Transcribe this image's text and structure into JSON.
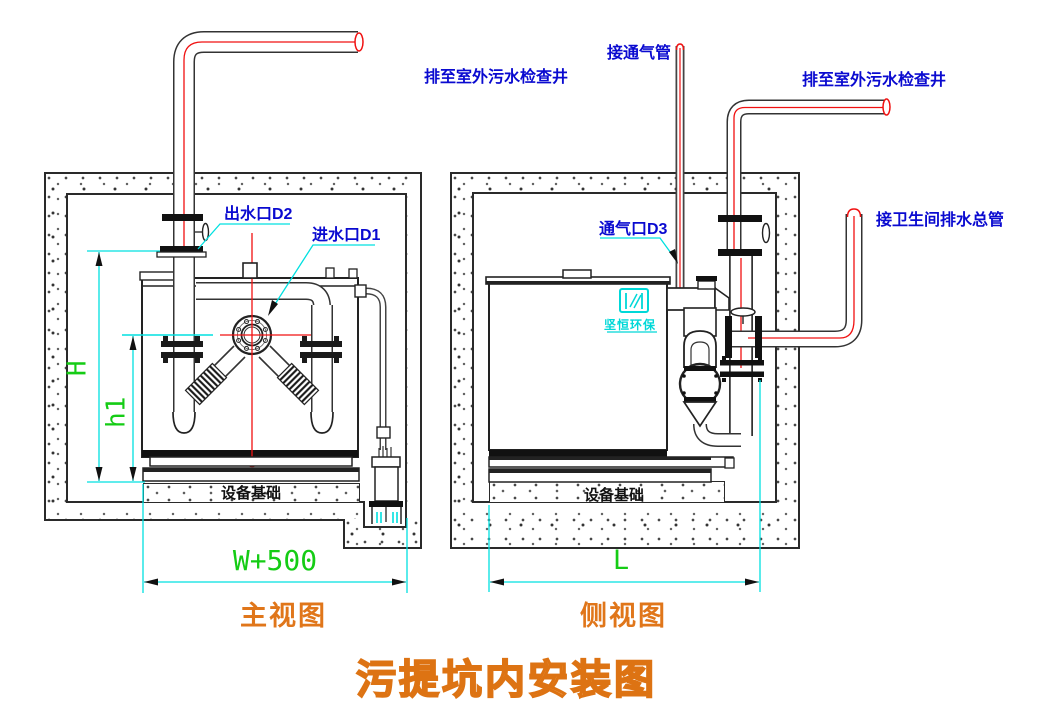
{
  "drawing_title": "污提坑内安装图",
  "front_view": {
    "caption": "主视图",
    "annotations": {
      "outfall": "排至室外污水检查井",
      "outlet": "出水口D2",
      "inlet": "进水口D1",
      "foundation": "设备基础"
    },
    "dimensions": {
      "pit_height": "H",
      "inlet_height": "h1",
      "pit_width": "W+500"
    }
  },
  "side_view": {
    "caption": "侧视图",
    "annotations": {
      "vent_connect": "接通气管",
      "outfall": "排至室外污水检查井",
      "vent_port": "通气口D3",
      "toilet_main": "接卫生间排水总管",
      "foundation": "设备基础"
    },
    "dimensions": {
      "pit_length": "L"
    }
  },
  "logo": {
    "brand": "坚恒环保"
  },
  "colors": {
    "annotation_blue": "#0a0ad0",
    "dimension_cyan": "#00e0e0",
    "dimension_green": "#15cc15",
    "caption_orange": "#e0761a",
    "centerline_red": "#f01010",
    "line_dark": "#222222"
  }
}
